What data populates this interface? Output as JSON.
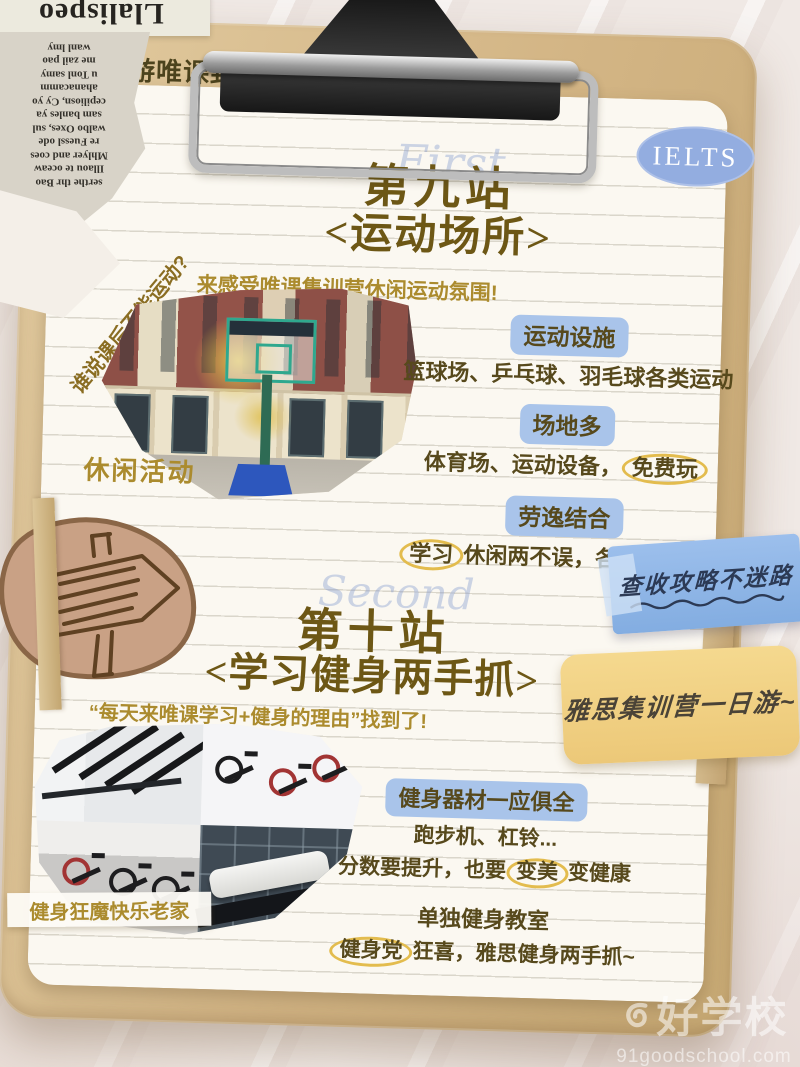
{
  "colors": {
    "accent_gold": "#ab8b2e",
    "title_brown": "#6d5715",
    "body_olive": "#57491c",
    "highlight_blue": "#a9c4ea",
    "circle_yellow": "#e3bc4e",
    "badge_blue": "#93ade0",
    "note_blue": "#8db6e6",
    "note_yellow": "#f2d286",
    "board_wood": "#d6bc8e"
  },
  "header": {
    "hashtag": "#云游唯课封闭班",
    "badge": "IELTS"
  },
  "newspaper": {
    "headline": "Llalispeo",
    "lines": [
      "serthe thr Bao",
      "Illaou te oceaw",
      "Mhlyer and coes",
      "re Fuessl ode",
      "walbo Oxes, sul",
      "sam banles ya",
      "cepiliosn, Cy yo",
      "ahanacamm",
      "u Tonl samy",
      "me zail pao",
      "wanl lmy"
    ]
  },
  "section1": {
    "script_word": "First",
    "title": "第九站",
    "subtitle": "<运动场所>",
    "photo_rotated_note": "谁说课后不能运动?",
    "photo_intro": "来感受唯课集训营休闲运动氛围!",
    "photo_caption": "休闲活动",
    "items": [
      {
        "heading": "运动设施",
        "pre": "篮球场、乒乓球、羽毛球各类运动",
        "circled": "",
        "post": ""
      },
      {
        "heading": "场地多",
        "pre": "体育场、运动设备，",
        "circled": "免费玩",
        "post": ""
      },
      {
        "heading": "劳逸结合",
        "pre": "",
        "circled": "学习",
        "post": "休闲两不误，各项全能发展"
      }
    ]
  },
  "stickers": {
    "blue_note": "查收攻略不迷路",
    "yellow_note": "雅思集训营一日游~"
  },
  "section2": {
    "script_word": "Second",
    "title": "第十站",
    "subtitle": "<学习健身两手抓>",
    "photo_intro": "“每天来唯课学习+健身的理由”找到了!",
    "photo_caption": "健身狂魔快乐老家",
    "block1": {
      "heading": "健身器材一应俱全",
      "line1": "跑步机、杠铃...",
      "line2_pre": "分数要提升，也要",
      "line2_circled": "变美",
      "line2_post": "变健康"
    },
    "block2": {
      "heading": "单独健身教室",
      "line_pre": "",
      "line_circled": "健身党",
      "line_post": "狂喜，雅思健身两手抓~"
    }
  },
  "watermark": {
    "brand": "好学校",
    "domain": "91goodschool.com"
  }
}
